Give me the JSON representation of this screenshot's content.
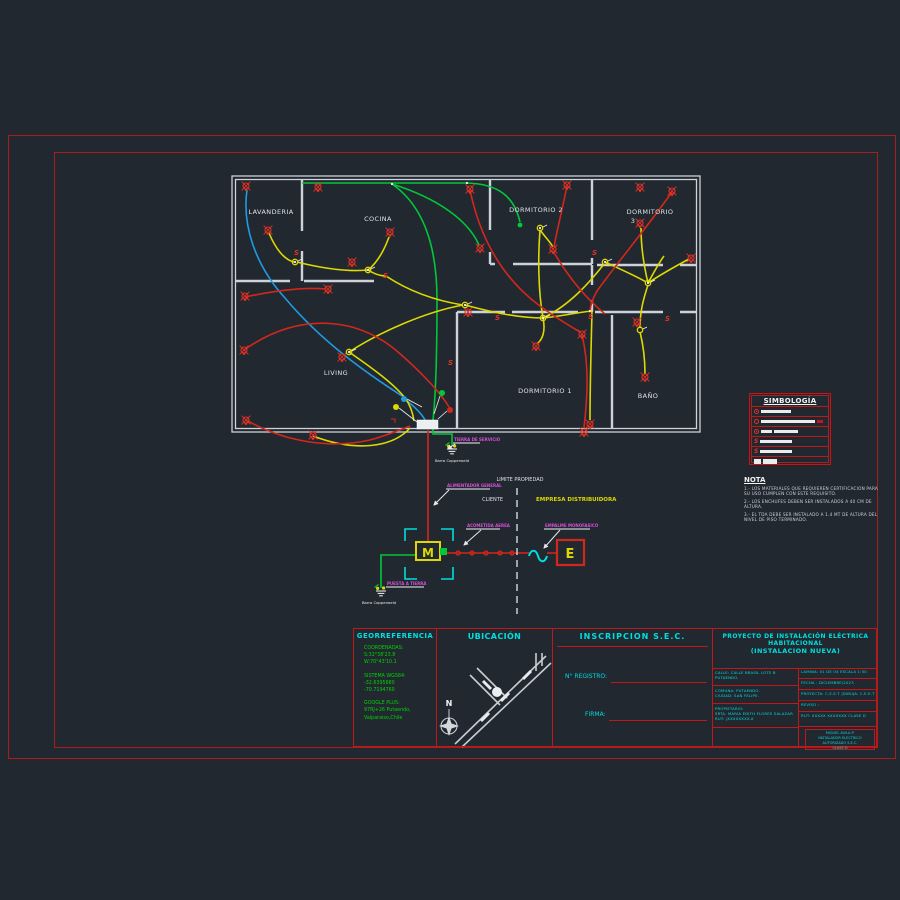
{
  "canvas": {
    "bg": "#212830",
    "frame_color": "#a81d1d"
  },
  "plan": {
    "rooms": {
      "lavanderia": "LAVANDERIA",
      "cocina": "COCINA",
      "dormitorio2": "DORMITORIO 2",
      "dormitorio3_l1": "DORMITORIO",
      "dormitorio3_l2": "3",
      "living": "LIVING",
      "dormitorio1": "DORMITORIO 1",
      "bano": "BAÑO"
    },
    "symbols": {
      "switch_letter": "S",
      "lamp": "ceiling-light-symbol",
      "junction": "junction-box-symbol"
    },
    "wire_colors": {
      "circuit_red": "#d4271b",
      "circuit_yellow": "#ddd900",
      "circuit_green": "#00c838",
      "circuit_blue": "#1e9ce0"
    }
  },
  "diagram": {
    "limite": "LIMITE PROPIEDAD",
    "cliente": "CLIENTE",
    "empresa": "EMPRESA DISTRIBUIDORA",
    "meter_letter": "M",
    "empalme_letter": "E",
    "labels": {
      "alimentador": "ALIMENTADOR GENERAL",
      "acometida": "ACOMETIDA AEREA",
      "empalme": "EMPALME MONOFASICO",
      "tierra_servicio": "TIERRA DE SERVICIO",
      "puesta_tierra": "PUESTA A TIERRA",
      "barra1": "Barra Copperweld",
      "barra2": "Barra Copperweld"
    }
  },
  "legend": {
    "title": "SIMBOLOGÍA"
  },
  "nota": {
    "title": "NOTA",
    "items": [
      "1.-  LOS MATERIALES QUE REQUIEREN CERTIFICACION PARA SU USO CUMPLEN CON ESTE REQUISITO.",
      "2.-  LOS ENCHUFES DEBEN SER INSTALADOS A 40 CM DE ALTURA.",
      "3.-  EL TDA DEBE SER INSTALADO A 1.4 MT DE ALTURA DEL NIVEL DE PISO TERMINADO."
    ]
  },
  "titleblock": {
    "georef": {
      "header": "GEORREFERENCIA",
      "coordenadas_label": "COORDENADAS:",
      "coord1": "S:32°38'23.8",
      "coord2": "W:70°43'10.1",
      "sistema_label": "SISTEMA WGS84:",
      "wgs1": "-32.6395880",
      "wgs2": "-70.7194760",
      "google_label": "GOOGLE PLUS:",
      "plus1": "97RJ+26 Putaendo,",
      "plus2": "Valparaiso,Chile"
    },
    "ubicacion": {
      "header": "UBICACIÓN",
      "north": "N"
    },
    "inscripcion": {
      "header": "INSCRIPCION  S.E.C.",
      "registro": "N° REGISTRO:",
      "firma": "FIRMA:"
    },
    "proyecto": {
      "title1": "PROYECTO DE INSTALACIÓN ELÉCTRICA",
      "title2": "HABITACIONAL",
      "title3": "(INSTALACION NUEVA)",
      "calle1": "CALLE: CALLE BRASIL LOTE B",
      "calle2": "PUTAENDO.",
      "comuna": "COMUNA: PUTAENDO.",
      "ciudad": "CIUDAD: SAN FELIPE.",
      "prop_label": "PROPIETARIO:",
      "prop_name": "SRTA. MARIA EDITH FLORES SALAZAR",
      "prop_rut": "RUT: |XXXXXXXX-X",
      "lamina": "LAMINA: 01 DE 04    ESCALA    1:50",
      "fecha": "FECHA : DICIEMBRE/2023",
      "proyecta": "PROYECTA: C.E.E.T   |DIBUJA: C.E.E.T",
      "reviso": "REVISO :",
      "rut": "RUT: XXXXX XXXXXXX      CLASE D",
      "firma_l1": "MIGUEL AVILA P.",
      "firma_l2": "INSTALADOR ELECTRICO",
      "firma_l3": "AUTORIZADO S.E.C.",
      "firma_l4": "CLASE D"
    }
  }
}
